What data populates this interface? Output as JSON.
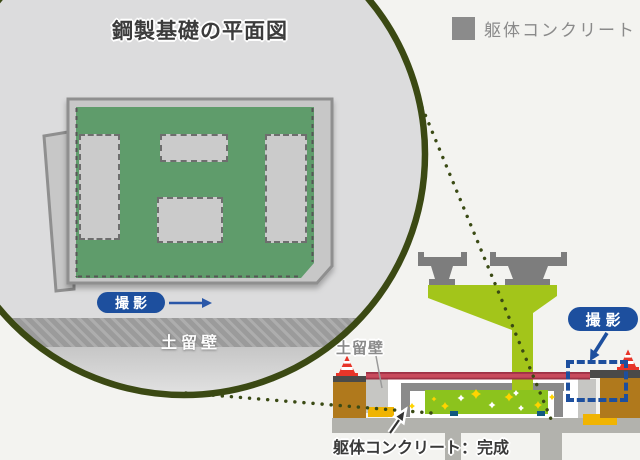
{
  "palette": {
    "background": "#f3f3f0",
    "accent_blue": "#1d4f9e",
    "plan_green": "#5f9c6b",
    "lime_green": "#8cc31d",
    "concrete_gray": "#8b8b8b",
    "soil_brown": "#b0791c",
    "deck_red": "#c84a5c",
    "safety_yellow": "#f0b402",
    "cone_red": "#e73529",
    "callout_olive": "#3a4a14"
  },
  "magnifier": {
    "title": "鋼製基礎の平面図",
    "shoot_label": "撮影",
    "wall_label": "土留壁"
  },
  "legend": {
    "swatch_color": "#8b8b8b",
    "label": "躯体コンクリート"
  },
  "section": {
    "wall_label": "土留壁",
    "shoot_label": "撮影",
    "caption": "躯体コンクリート：完成"
  }
}
